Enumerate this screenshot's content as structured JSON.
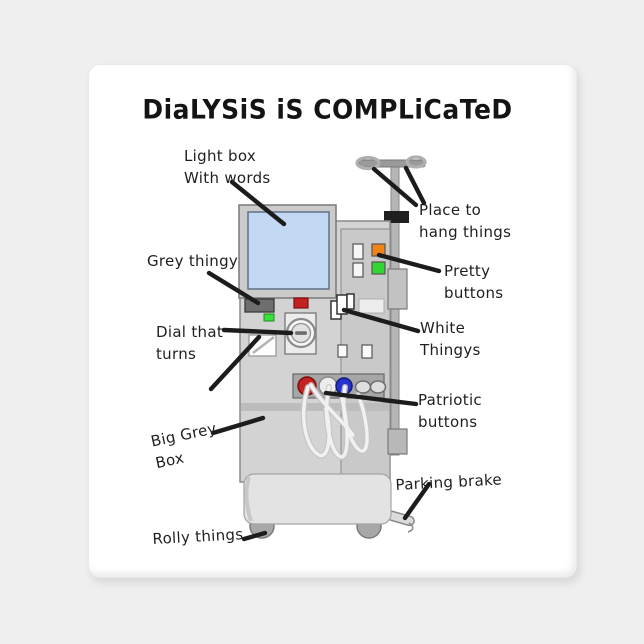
{
  "title": "DiaLYSiS iS COMPLiCaTeD",
  "annotations": {
    "light_box": {
      "line1": "Light box",
      "line2": "With words"
    },
    "grey_thingy": {
      "line1": "Grey thingy"
    },
    "dial": {
      "line1": "Dial that",
      "line2": "turns"
    },
    "big_grey_box": {
      "line1": "Big Grey",
      "line2": "Box"
    },
    "rolly_things": {
      "line1": "Rolly things"
    },
    "place_to_hang": {
      "line1": "Place to",
      "line2": "hang things"
    },
    "pretty_buttons": {
      "line1": "Pretty",
      "line2": "buttons"
    },
    "white_thingys": {
      "line1": "White",
      "line2": "Thingys"
    },
    "patriotic_buttons": {
      "line1": "Patriotic",
      "line2": "buttons"
    },
    "parking_brake": {
      "line1": "Parking brake"
    }
  },
  "colors": {
    "page_bg": "#efefef",
    "magnet": "#ffffff",
    "ink": "#1c1c1c",
    "screen": "#c3d9f3",
    "machine_body": "#d3d3d3",
    "machine_panel": "#c9c9c9",
    "orange_button": "#f08419",
    "green_button": "#33d433",
    "red_button": "#c32222",
    "blue_button": "#2633cc",
    "grey_display": "#6e6e6e"
  }
}
